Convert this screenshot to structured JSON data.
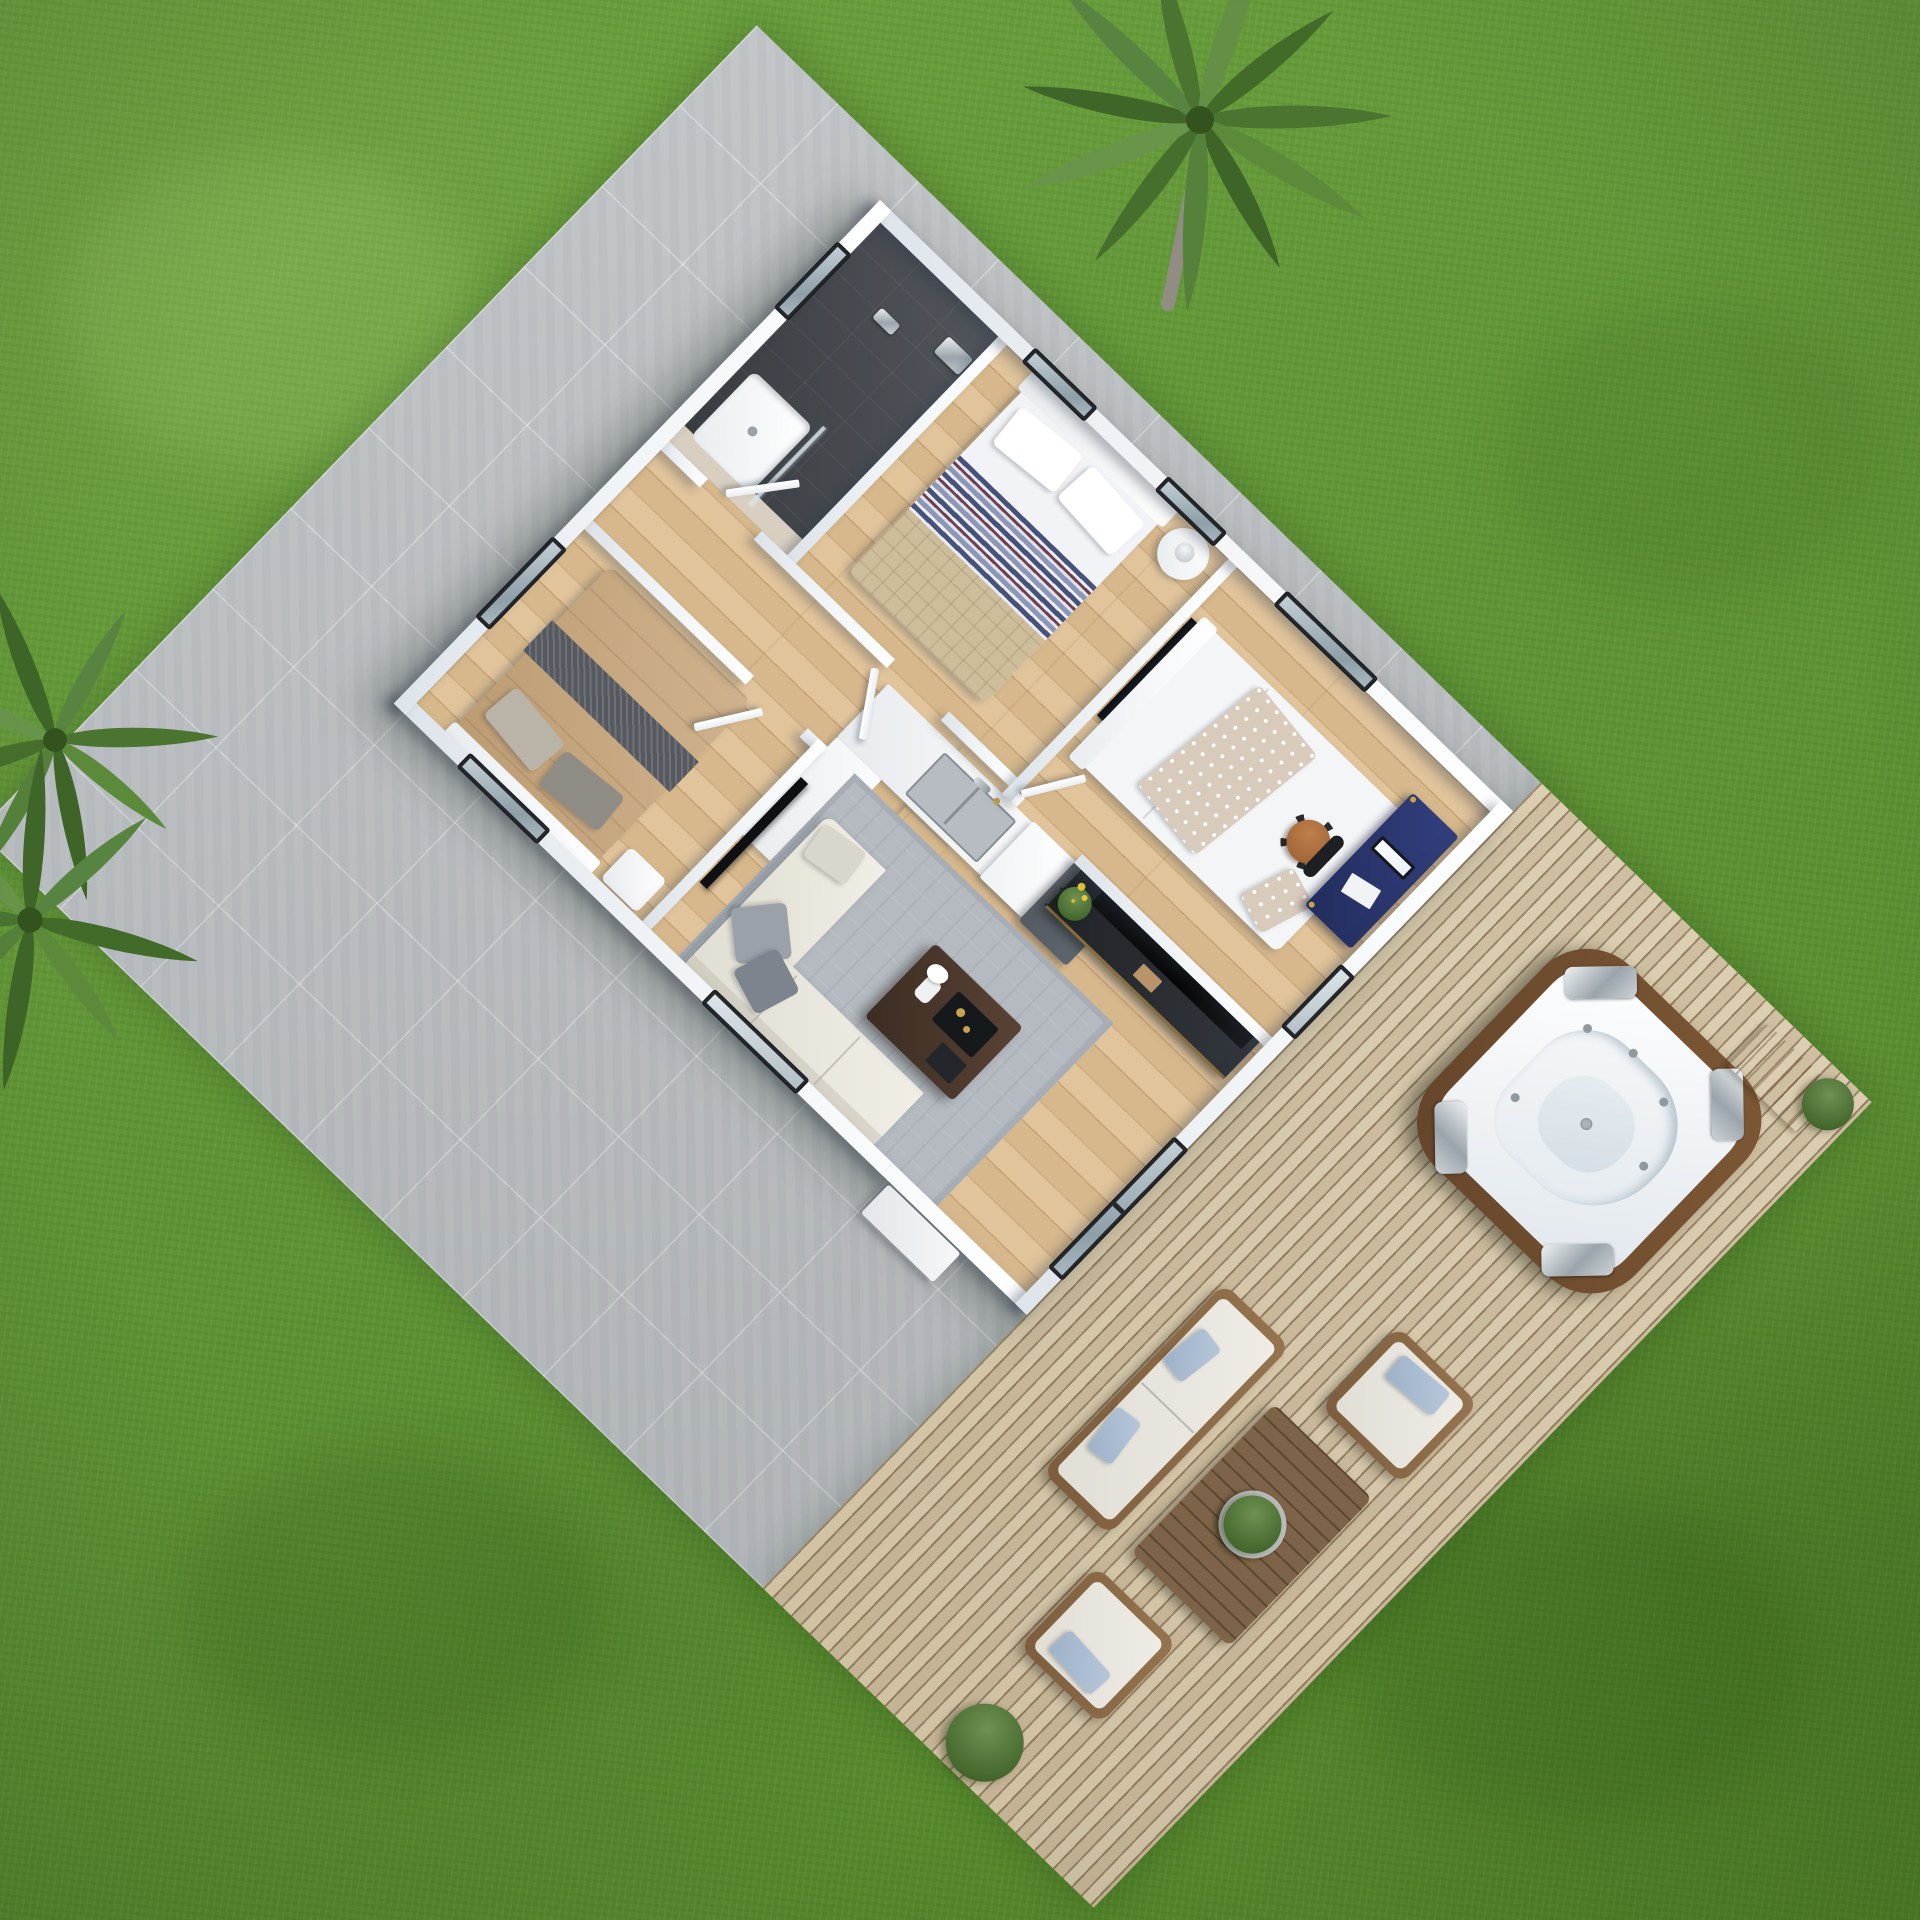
{
  "scene": {
    "type": "3d-floorplan-render",
    "description": "Isometric 3D render of a small single-storey house with cut-away roof, on a concrete tile pad with wooden deck, hot tub, outdoor lounge set, palm trees and lawn",
    "ground": "grass lawn",
    "camera": "high isometric"
  },
  "palette": {
    "grass": "#5d9134",
    "concrete_pad": "#bdc1c4",
    "deck_wood": "#d8c8a7",
    "wall_white": "#f4f6f8",
    "floor_wood": "#dfc093",
    "bathroom_tile": "#43484e",
    "window_frame": "#24282c",
    "rug_gray": "#b4bac0",
    "sofa_cream": "#eeebe2",
    "desk_navy": "#2a3566",
    "office_chair_orange": "#a8683a",
    "hot_tub_wood": "#72502f",
    "outdoor_cushion": "#e7e5de",
    "outdoor_pillow_blue": "#a9bcd3",
    "dining_wood": "#d8b586",
    "tv_black": "#0b0d0f",
    "plant_green": "#4f7a3a"
  },
  "house": {
    "rooms": [
      {
        "name": "bedroom-striped",
        "position": "north corner",
        "windows": 2,
        "furniture": [
          "double bed with blue striped duvet",
          "white pillows",
          "white headboard",
          "round nightstand",
          "table lamp"
        ]
      },
      {
        "name": "bathroom",
        "position": "north-west",
        "windows": 1,
        "finish": "dark gray tiles",
        "furniture": [
          "walk-in shower",
          "glass partition",
          "white shower tray",
          "chrome fixture"
        ]
      },
      {
        "name": "bedroom-tan",
        "position": "west corner",
        "windows": 2,
        "furniture": [
          "double bed with tan duvet",
          "dark gray throw runner",
          "gray pillows",
          "nightstand"
        ]
      },
      {
        "name": "bedroom-white",
        "position": "east",
        "windows": 2,
        "furniture": [
          "double bed with white duvet",
          "polka-dot throw",
          "polka-dot pillow",
          "wall tv",
          "navy desk",
          "monitor",
          "papers",
          "orange swivel chair"
        ]
      },
      {
        "name": "kitchen",
        "position": "center",
        "windows": 0,
        "furniture": [
          "white cabinets",
          "marble countertop",
          "double stainless sink",
          "faucet",
          "tall cabinet",
          "dark gray fridge"
        ]
      },
      {
        "name": "dining",
        "position": "center",
        "windows": 0,
        "furniture": [
          "wooden dining table",
          "4 white chairs",
          "4 white plate settings",
          "salad bowl",
          "glasses",
          "cutlery",
          "candles"
        ]
      },
      {
        "name": "living",
        "position": "south corner",
        "windows": 1,
        "doors": [
          "sliding glass door"
        ],
        "furniture": [
          "L-shaped cream sofa",
          "gray pillows",
          "gray rug",
          "dark coffee table with decor",
          "black tv console",
          "large tv",
          "plant with yellow flowers",
          "white hallway wardrobe"
        ]
      }
    ],
    "doors_open": 4
  },
  "outdoor": {
    "deck_items": [
      {
        "name": "hot-tub",
        "detail": "white shell, wooden skirt, 4 chrome headrests, jets"
      },
      {
        "name": "wooden-step-mat"
      },
      {
        "name": "outdoor-sofa",
        "detail": "wood frame, white cushions, 2 blue pillows"
      },
      {
        "name": "outdoor-armchair-north"
      },
      {
        "name": "outdoor-armchair-south"
      },
      {
        "name": "slatted-coffee-table",
        "detail": "round green planter centerpiece"
      },
      {
        "name": "potted-plant-corner"
      },
      {
        "name": "potted-plant-bottom"
      }
    ],
    "lawn_items": [
      {
        "name": "palm-tree-top-right"
      },
      {
        "name": "palm-tree-left"
      }
    ]
  }
}
